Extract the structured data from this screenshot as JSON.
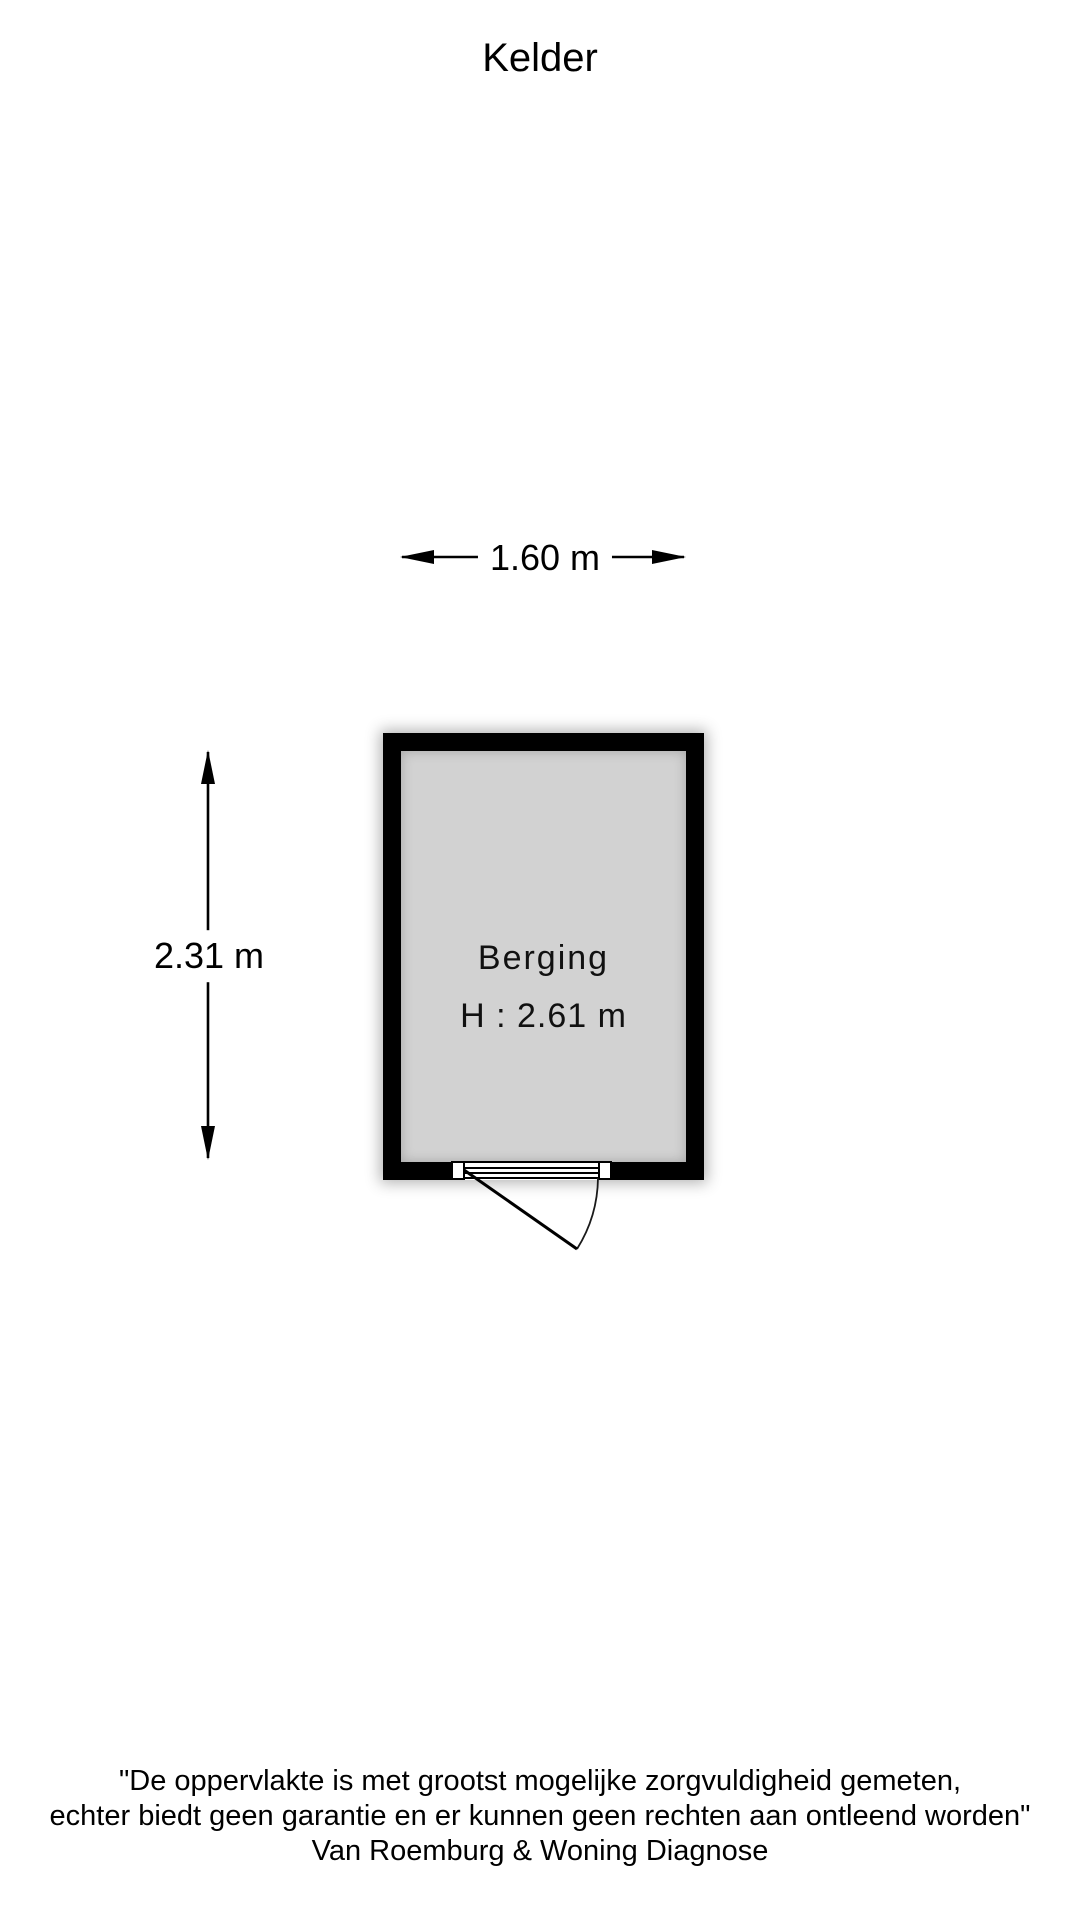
{
  "page": {
    "title": "Kelder"
  },
  "floorplan": {
    "room": {
      "name": "Berging",
      "ceiling_height_label": "H : 2.61 m"
    },
    "dimensions": {
      "width_label": "1.60 m",
      "depth_label": "2.31 m"
    },
    "colors": {
      "wall": "#000000",
      "floor": "#d2d2d2",
      "line": "#000000",
      "background": "#ffffff"
    }
  },
  "footer": {
    "disclaimer_line1": "\"De oppervlakte is met grootst mogelijke zorgvuldigheid gemeten,",
    "disclaimer_line2": "echter biedt geen garantie en er kunnen geen rechten aan ontleend worden\"",
    "company": "Van Roemburg & Woning Diagnose"
  }
}
